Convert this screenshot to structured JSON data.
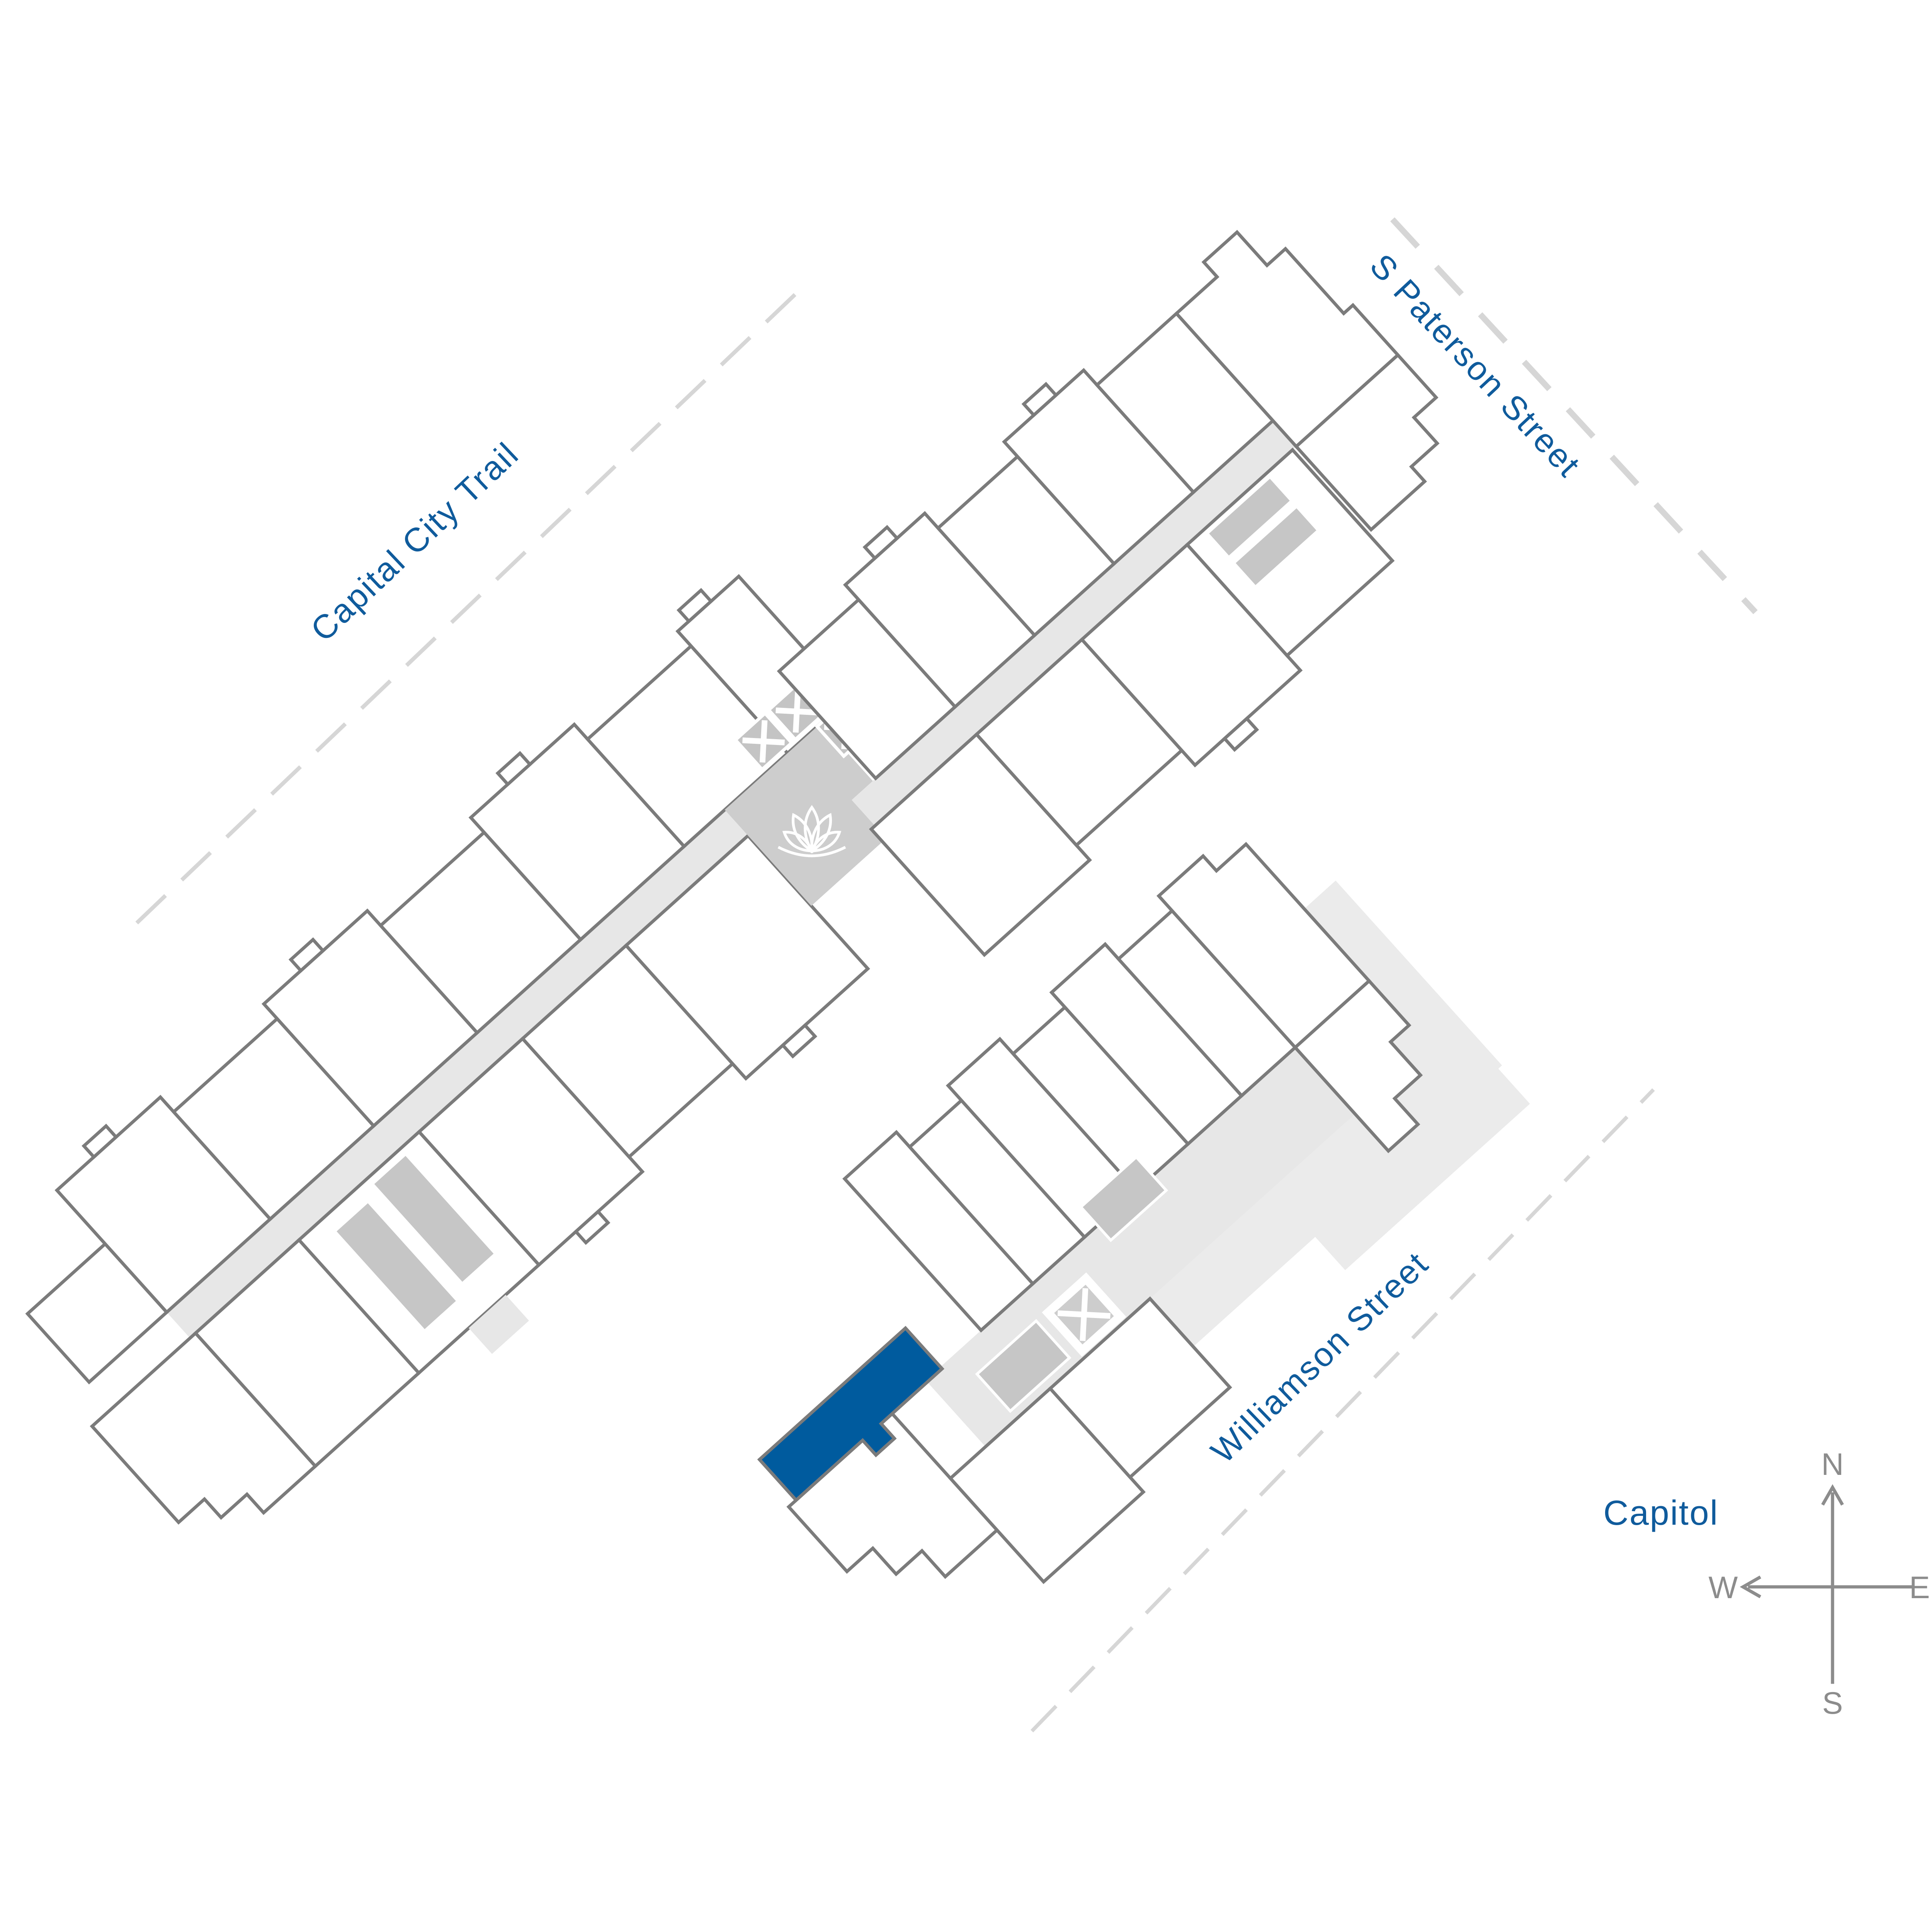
{
  "map": {
    "streets": [
      {
        "id": "capital-city-trail",
        "label": "Capital City Trail"
      },
      {
        "id": "s-paterson-street",
        "label": "S Paterson Street"
      },
      {
        "id": "williamson-street",
        "label": "Williamson Street"
      }
    ],
    "landmark": {
      "label": "Capitol"
    },
    "compass": {
      "north": "N",
      "south": "S",
      "east": "E",
      "west": "W"
    },
    "icons": [
      {
        "name": "lotus-icon"
      },
      {
        "name": "elevator-icon"
      },
      {
        "name": "stair-icon"
      },
      {
        "name": "compass-rose-icon"
      }
    ],
    "highlighted_unit": {
      "color": "#005B9E"
    }
  },
  "colors": {
    "accent": "#0F5B9C",
    "unit_highlight": "#005B9E",
    "outline_gray": "#7B7B7B",
    "corridor_gray": "#E7E7E7",
    "courtyard_gray": "#CDCDCD",
    "box_gray": "#C6C6C6",
    "terrace_gray": "#EBEBEB",
    "dash_gray": "#D6D6D6",
    "compass_gray": "#8C8C8C",
    "page_bg": "#FFFFFF"
  }
}
